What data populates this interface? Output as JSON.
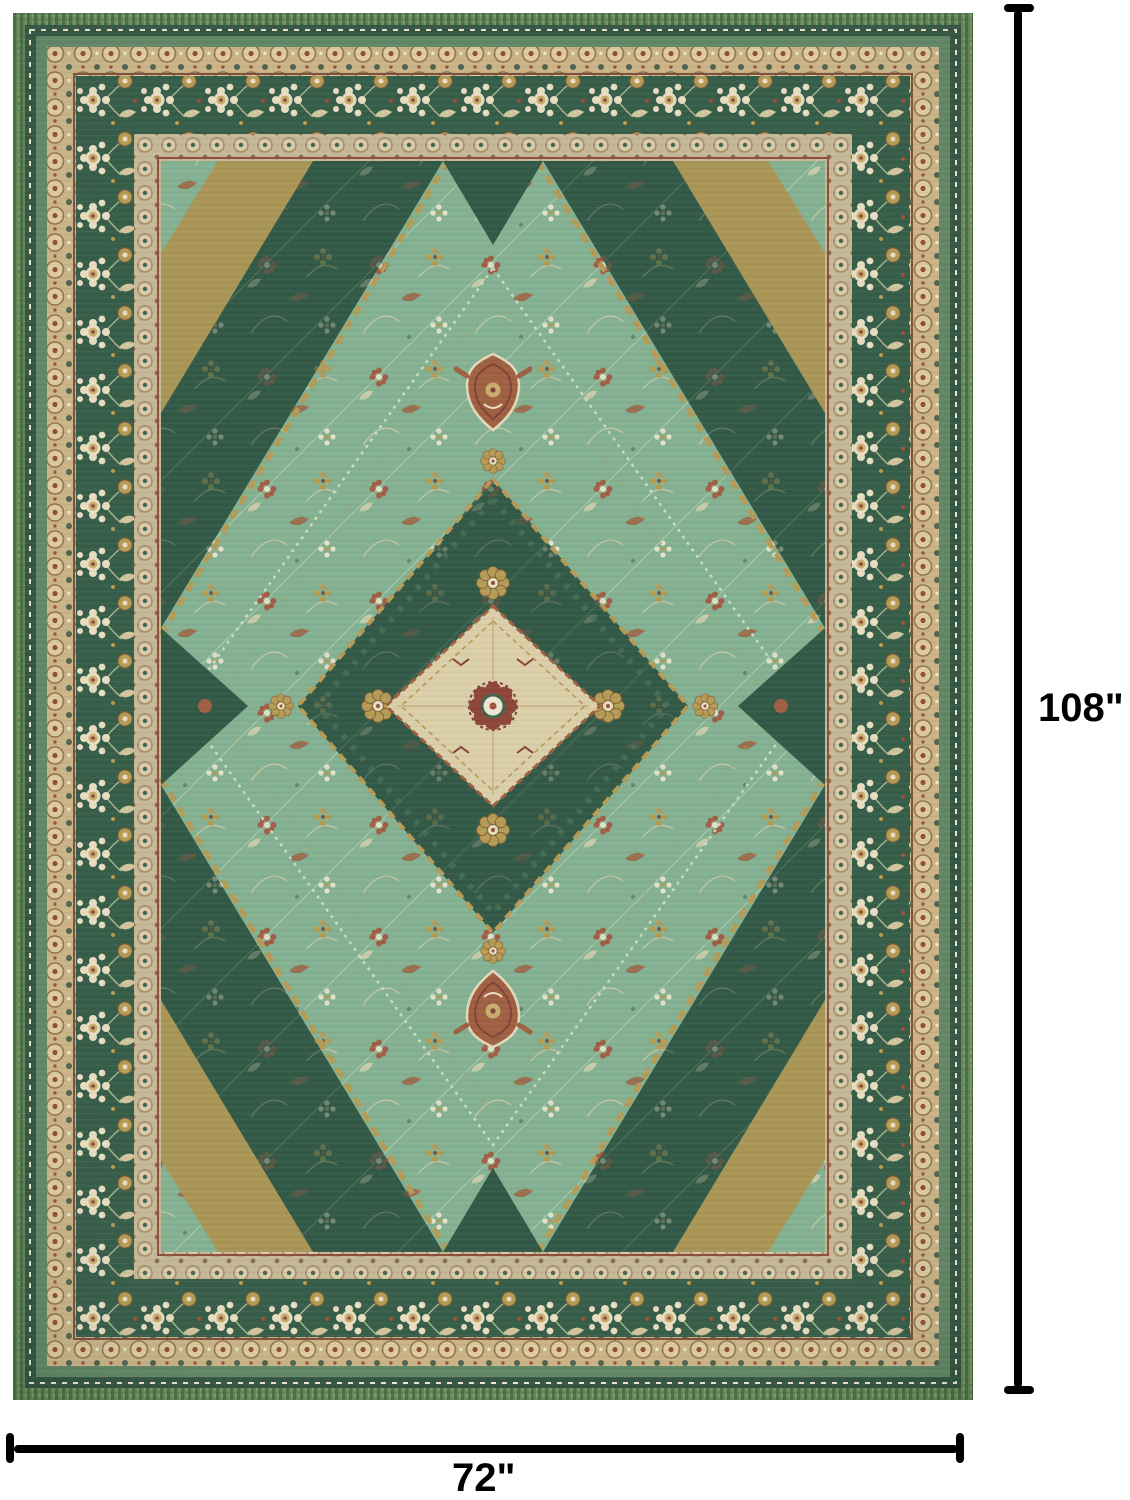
{
  "image": {
    "type": "product dimension photo",
    "subject": "vintage distressed oriental medallion area rug",
    "background_color": "#ffffff"
  },
  "dimensions": {
    "height": "108\"",
    "width": "72\"",
    "line_color": "#000000"
  },
  "rug_palette": {
    "field_green": "#7fae8e",
    "dark_green": "#2b5240",
    "border_green": "#2f5742",
    "edge_green": "#5d8150",
    "gold": "#b3974f",
    "olive_gold": "#a6924f",
    "cream": "#e7dcc0",
    "tan_band": "#c8b183",
    "rust": "#9b5a3b",
    "maroon": "#7e3b30"
  }
}
